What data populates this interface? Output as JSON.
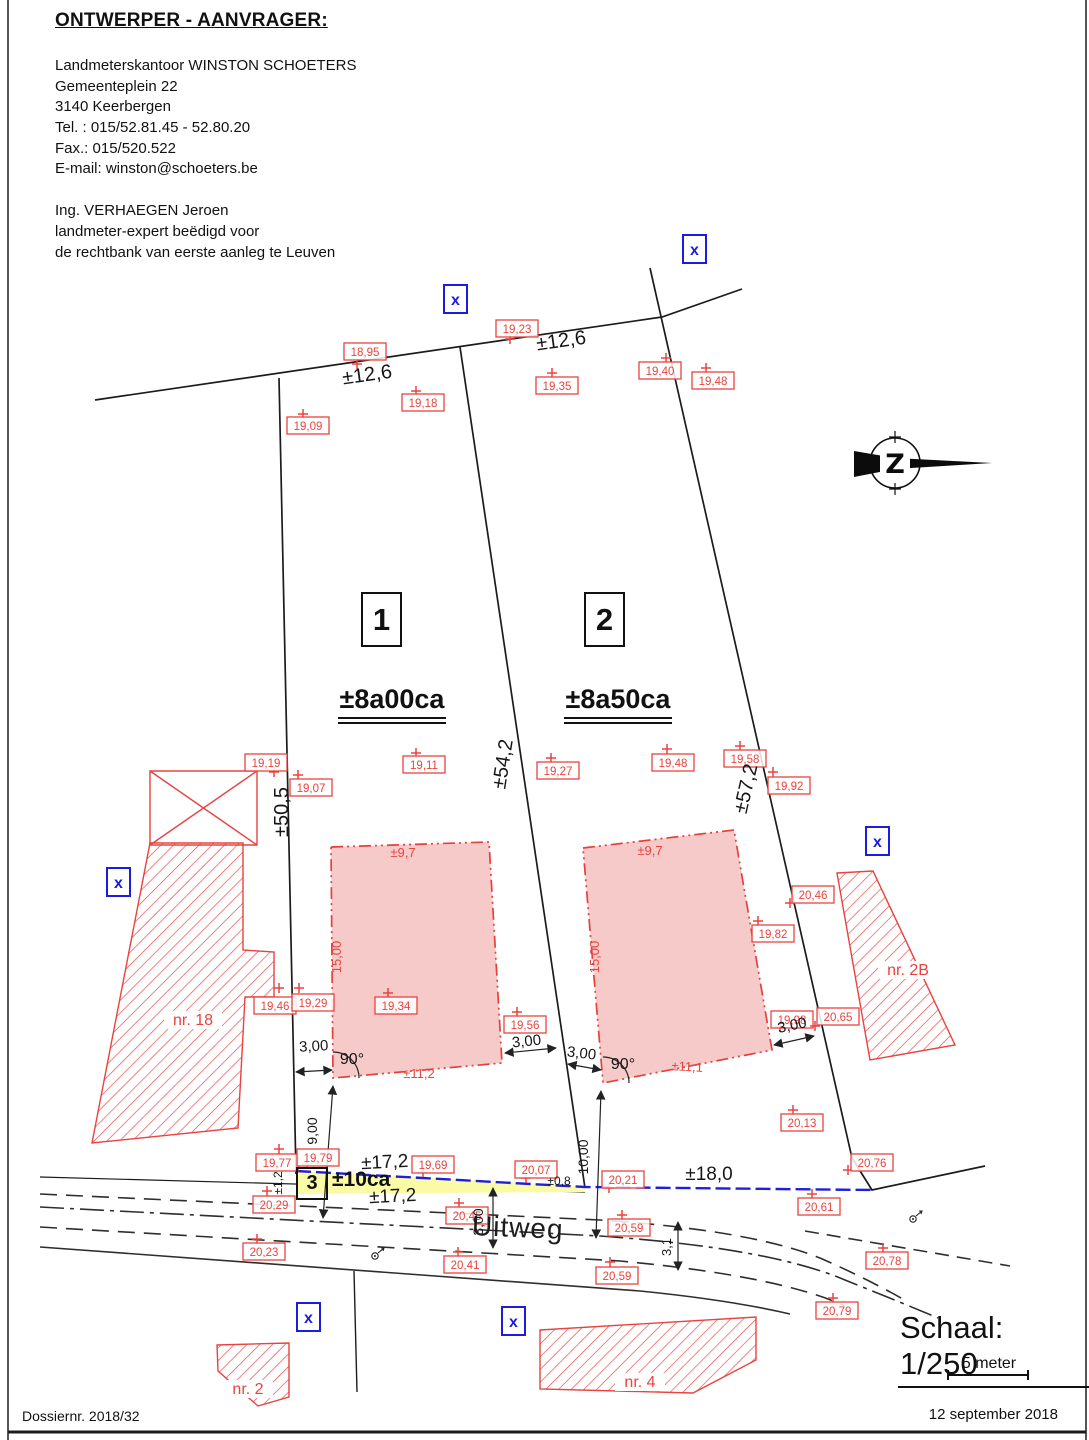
{
  "header": {
    "title": "ONTWERPER - AANVRAGER:",
    "office_lines": [
      "Landmeterskantoor WINSTON SCHOETERS",
      "Gemeenteplein 22",
      "3140 Keerbergen",
      "Tel. : 015/52.81.45 -  52.80.20",
      "Fax.: 015/520.522",
      "E-mail: winston@schoeters.be"
    ],
    "surveyor_lines": [
      "Ing. VERHAEGEN Jeroen",
      "landmeter-expert beëdigd voor",
      "de rechtbank van eerste aanleg te Leuven"
    ]
  },
  "parcels": [
    {
      "number": "1",
      "area_label": "±8a00ca"
    },
    {
      "number": "2",
      "area_label": "±8a50ca"
    },
    {
      "number": "3",
      "area_label": "±10ca"
    }
  ],
  "road_name": "Uitweg",
  "north_arrow": {
    "letter": "Z"
  },
  "scale_block": {
    "title": "Schaal: 1/250",
    "bar_label": "5 meter"
  },
  "footer": {
    "dossier": "Dossiernr. 2018/32",
    "date": "12 september 2018"
  },
  "x_glyph": "x",
  "x_marks": [
    {
      "x": 444,
      "y": 285
    },
    {
      "x": 683,
      "y": 235
    },
    {
      "x": 107,
      "y": 868
    },
    {
      "x": 866,
      "y": 827
    },
    {
      "x": 297,
      "y": 1303
    },
    {
      "x": 502,
      "y": 1307
    }
  ],
  "neighbor_labels": [
    {
      "t": "nr. 18",
      "x": 193,
      "y": 1025,
      "w": 58
    },
    {
      "t": "nr. 2B",
      "x": 908,
      "y": 975,
      "w": 60
    },
    {
      "t": "nr. 2",
      "x": 248,
      "y": 1394,
      "w": 50
    },
    {
      "t": "nr. 4",
      "x": 640,
      "y": 1387,
      "w": 50
    }
  ],
  "elevation_markers": [
    {
      "v": "18,95",
      "bx": 344,
      "by": 343,
      "cx": 357,
      "cy": 364
    },
    {
      "v": "19,23",
      "bx": 496,
      "by": 320,
      "cx": 510,
      "cy": 339
    },
    {
      "v": "19,35",
      "bx": 536,
      "by": 377,
      "cx": 552,
      "cy": 373
    },
    {
      "v": "19,40",
      "bx": 639,
      "by": 362,
      "cx": 666,
      "cy": 358
    },
    {
      "v": "19,48",
      "bx": 692,
      "by": 372,
      "cx": 706,
      "cy": 368
    },
    {
      "v": "19,18",
      "bx": 402,
      "by": 394,
      "cx": 416,
      "cy": 391
    },
    {
      "v": "19,09",
      "bx": 287,
      "by": 417,
      "cx": 303,
      "cy": 414
    },
    {
      "v": "19,19",
      "bx": 245,
      "by": 754,
      "cx": 274,
      "cy": 772
    },
    {
      "v": "19,07",
      "bx": 290,
      "by": 779,
      "cx": 298,
      "cy": 775
    },
    {
      "v": "19,11",
      "bx": 403,
      "by": 756,
      "cx": 416,
      "cy": 753
    },
    {
      "v": "19,27",
      "bx": 537,
      "by": 762,
      "cx": 551,
      "cy": 758
    },
    {
      "v": "19,48",
      "bx": 652,
      "by": 754,
      "cx": 667,
      "cy": 749
    },
    {
      "v": "19,58",
      "bx": 724,
      "by": 750,
      "cx": 740,
      "cy": 746
    },
    {
      "v": "19,92",
      "bx": 768,
      "by": 777,
      "cx": 773,
      "cy": 772
    },
    {
      "v": "20,46",
      "bx": 792,
      "by": 886,
      "cx": 790,
      "cy": 903
    },
    {
      "v": "19,82",
      "bx": 752,
      "by": 925,
      "cx": 758,
      "cy": 921
    },
    {
      "v": "19,46",
      "bx": 254,
      "by": 997,
      "cx": 279,
      "cy": 988
    },
    {
      "v": "19,29",
      "bx": 292,
      "by": 994,
      "cx": 299,
      "cy": 988
    },
    {
      "v": "19,34",
      "bx": 375,
      "by": 997,
      "cx": 388,
      "cy": 993
    },
    {
      "v": "19,56",
      "bx": 504,
      "by": 1016,
      "cx": 517,
      "cy": 1012
    },
    {
      "v": "19,98",
      "bx": 771,
      "by": 1011,
      "cx": 780,
      "cy": 1027
    },
    {
      "v": "20,65",
      "bx": 817,
      "by": 1008,
      "cx": 815,
      "cy": 1026
    },
    {
      "v": "20,13",
      "bx": 781,
      "by": 1114,
      "cx": 793,
      "cy": 1110
    },
    {
      "v": "19,77",
      "bx": 256,
      "by": 1154,
      "cx": 279,
      "cy": 1149
    },
    {
      "v": "19,79",
      "bx": 297,
      "by": 1149,
      "cx": 307,
      "cy": 1164
    },
    {
      "v": "19,69",
      "bx": 412,
      "by": 1156,
      "cx": 423,
      "cy": 1172
    },
    {
      "v": "20,07",
      "bx": 515,
      "by": 1161,
      "cx": 526,
      "cy": 1178
    },
    {
      "v": "20,21",
      "bx": 602,
      "by": 1171,
      "cx": 609,
      "cy": 1188
    },
    {
      "v": "20,76",
      "bx": 851,
      "by": 1154,
      "cx": 848,
      "cy": 1170
    },
    {
      "v": "20,29",
      "bx": 253,
      "by": 1196,
      "cx": 267,
      "cy": 1191
    },
    {
      "v": "20,61",
      "bx": 798,
      "by": 1198,
      "cx": 812,
      "cy": 1194
    },
    {
      "v": "20,45",
      "bx": 446,
      "by": 1207,
      "cx": 459,
      "cy": 1203
    },
    {
      "v": "20,59",
      "bx": 608,
      "by": 1219,
      "cx": 622,
      "cy": 1215
    },
    {
      "v": "20,23",
      "bx": 243,
      "by": 1243,
      "cx": 257,
      "cy": 1239
    },
    {
      "v": "20,41",
      "bx": 444,
      "by": 1256,
      "cx": 458,
      "cy": 1252
    },
    {
      "v": "20,59",
      "bx": 596,
      "by": 1267,
      "cx": 610,
      "cy": 1262
    },
    {
      "v": "20,78",
      "bx": 866,
      "by": 1252,
      "cx": 883,
      "cy": 1248
    },
    {
      "v": "20,79",
      "bx": 816,
      "by": 1302,
      "cx": 833,
      "cy": 1298
    }
  ],
  "dim_labels": [
    {
      "t": "±12,6",
      "x": 368,
      "y": 381,
      "r": -8,
      "s": 20
    },
    {
      "t": "±12,6",
      "x": 562,
      "y": 347,
      "r": -8,
      "s": 20
    },
    {
      "t": "±50,5",
      "x": 288,
      "y": 812,
      "r": -90,
      "s": 20
    },
    {
      "t": "±54,2",
      "x": 509,
      "y": 765,
      "r": -81,
      "s": 20
    },
    {
      "t": "±57,2",
      "x": 752,
      "y": 790,
      "r": -77,
      "s": 20
    },
    {
      "t": "3,00",
      "x": 314,
      "y": 1051,
      "r": -3,
      "s": 15
    },
    {
      "t": "3,00",
      "x": 527,
      "y": 1046,
      "r": -6,
      "s": 15
    },
    {
      "t": "3,00",
      "x": 581,
      "y": 1058,
      "r": 7,
      "s": 15
    },
    {
      "t": "3,00",
      "x": 793,
      "y": 1030,
      "r": -12,
      "s": 15
    },
    {
      "t": "90°",
      "x": 352,
      "y": 1064,
      "r": 0,
      "s": 16
    },
    {
      "t": "90°",
      "x": 623,
      "y": 1069,
      "r": 0,
      "s": 16
    },
    {
      "t": "9,00",
      "x": 317,
      "y": 1131,
      "r": -90,
      "s": 14
    },
    {
      "t": "10,00",
      "x": 588,
      "y": 1157,
      "r": -90,
      "s": 14
    },
    {
      "t": "3,00",
      "x": 483,
      "y": 1222,
      "r": -90,
      "s": 14
    },
    {
      "t": "3,1",
      "x": 671,
      "y": 1247,
      "r": -90,
      "s": 13
    },
    {
      "t": "±17,2",
      "x": 385,
      "y": 1168,
      "r": -3,
      "s": 19
    },
    {
      "t": "±17,2",
      "x": 393,
      "y": 1202,
      "r": -3,
      "s": 19
    },
    {
      "t": "±18,0",
      "x": 709,
      "y": 1180,
      "r": 0,
      "s": 19
    },
    {
      "t": "±0,8",
      "x": 559,
      "y": 1185,
      "r": 0,
      "s": 12
    },
    {
      "t": "±1,2",
      "x": 282,
      "y": 1183,
      "r": -90,
      "s": 12
    }
  ],
  "red_dim_labels": [
    {
      "t": "±9,7",
      "x": 403,
      "y": 857,
      "s": 13
    },
    {
      "t": "±9,7",
      "x": 650,
      "y": 855,
      "s": 13
    },
    {
      "t": "15,00",
      "x": 341,
      "y": 957,
      "r": -90,
      "s": 13
    },
    {
      "t": "15,00",
      "x": 599,
      "y": 957,
      "r": -90,
      "s": 13
    },
    {
      "t": "±11,2",
      "x": 419,
      "y": 1078,
      "s": 13
    },
    {
      "t": "±11,1",
      "x": 687,
      "y": 1071,
      "r": 3,
      "s": 13
    }
  ],
  "colors": {
    "red": "#e8433f",
    "pink_fill": "#f7caca",
    "blue_marker": "#1c1ce0",
    "blue_line": "#1f1fdd",
    "yellow_fill": "#fbfba6",
    "line_black": "#1c1c1c"
  }
}
